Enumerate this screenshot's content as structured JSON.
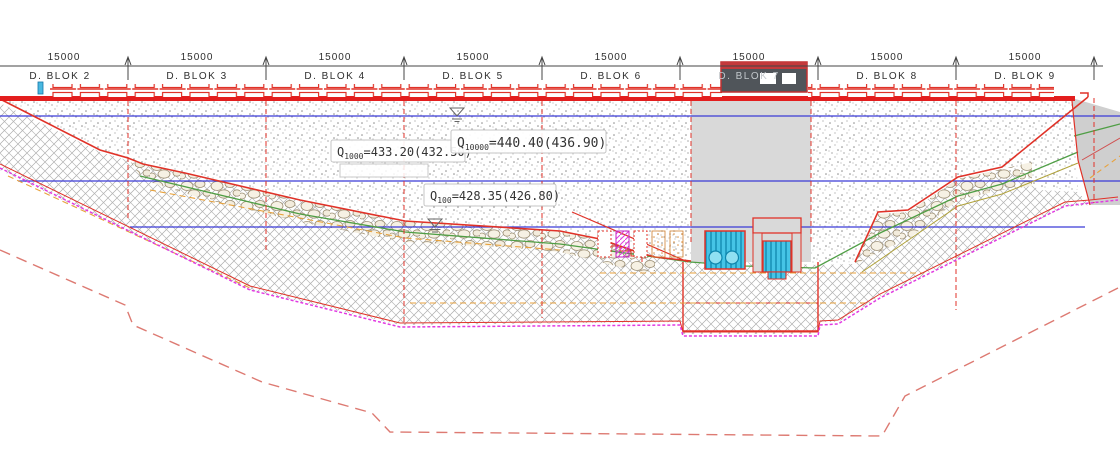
{
  "drawing": {
    "dimensions": [
      {
        "value": "15000"
      },
      {
        "value": "15000"
      },
      {
        "value": "15000"
      },
      {
        "value": "15000"
      },
      {
        "value": "15000"
      },
      {
        "value": "15000"
      },
      {
        "value": "15000"
      },
      {
        "value": "15000"
      }
    ],
    "blocks": [
      {
        "label": "D. BLOK 2"
      },
      {
        "label": "D. BLOK 3"
      },
      {
        "label": "D. BLOK 4"
      },
      {
        "label": "D. BLOK 5"
      },
      {
        "label": "D. BLOK 6"
      },
      {
        "label": "D. BLOK 7"
      },
      {
        "label": "D. BLOK 8"
      },
      {
        "label": "D. BLOK 9"
      }
    ],
    "annotations": {
      "q10000": {
        "prefix": "Q",
        "sub": "10000",
        "value": "=440.40(436.90)"
      },
      "q1000": {
        "prefix": "Q",
        "sub": "1000",
        "value": "=433.20(432.50)"
      },
      "q100": {
        "prefix": "Q",
        "sub": "100",
        "value": "=428.35(426.80)"
      }
    },
    "colors": {
      "structure_red": "#e03228",
      "water_blue": "#3b3bd6",
      "excavation_magenta": "#e23ae2",
      "terrain_green": "#4f9e45",
      "strata_orange": "#e8a23c",
      "gate_cyan": "#45c4e6",
      "concrete_gray": "#d9d9d9",
      "building_dark": "#50555a",
      "deep_excavation_dash_red": "#dd7a72"
    }
  }
}
